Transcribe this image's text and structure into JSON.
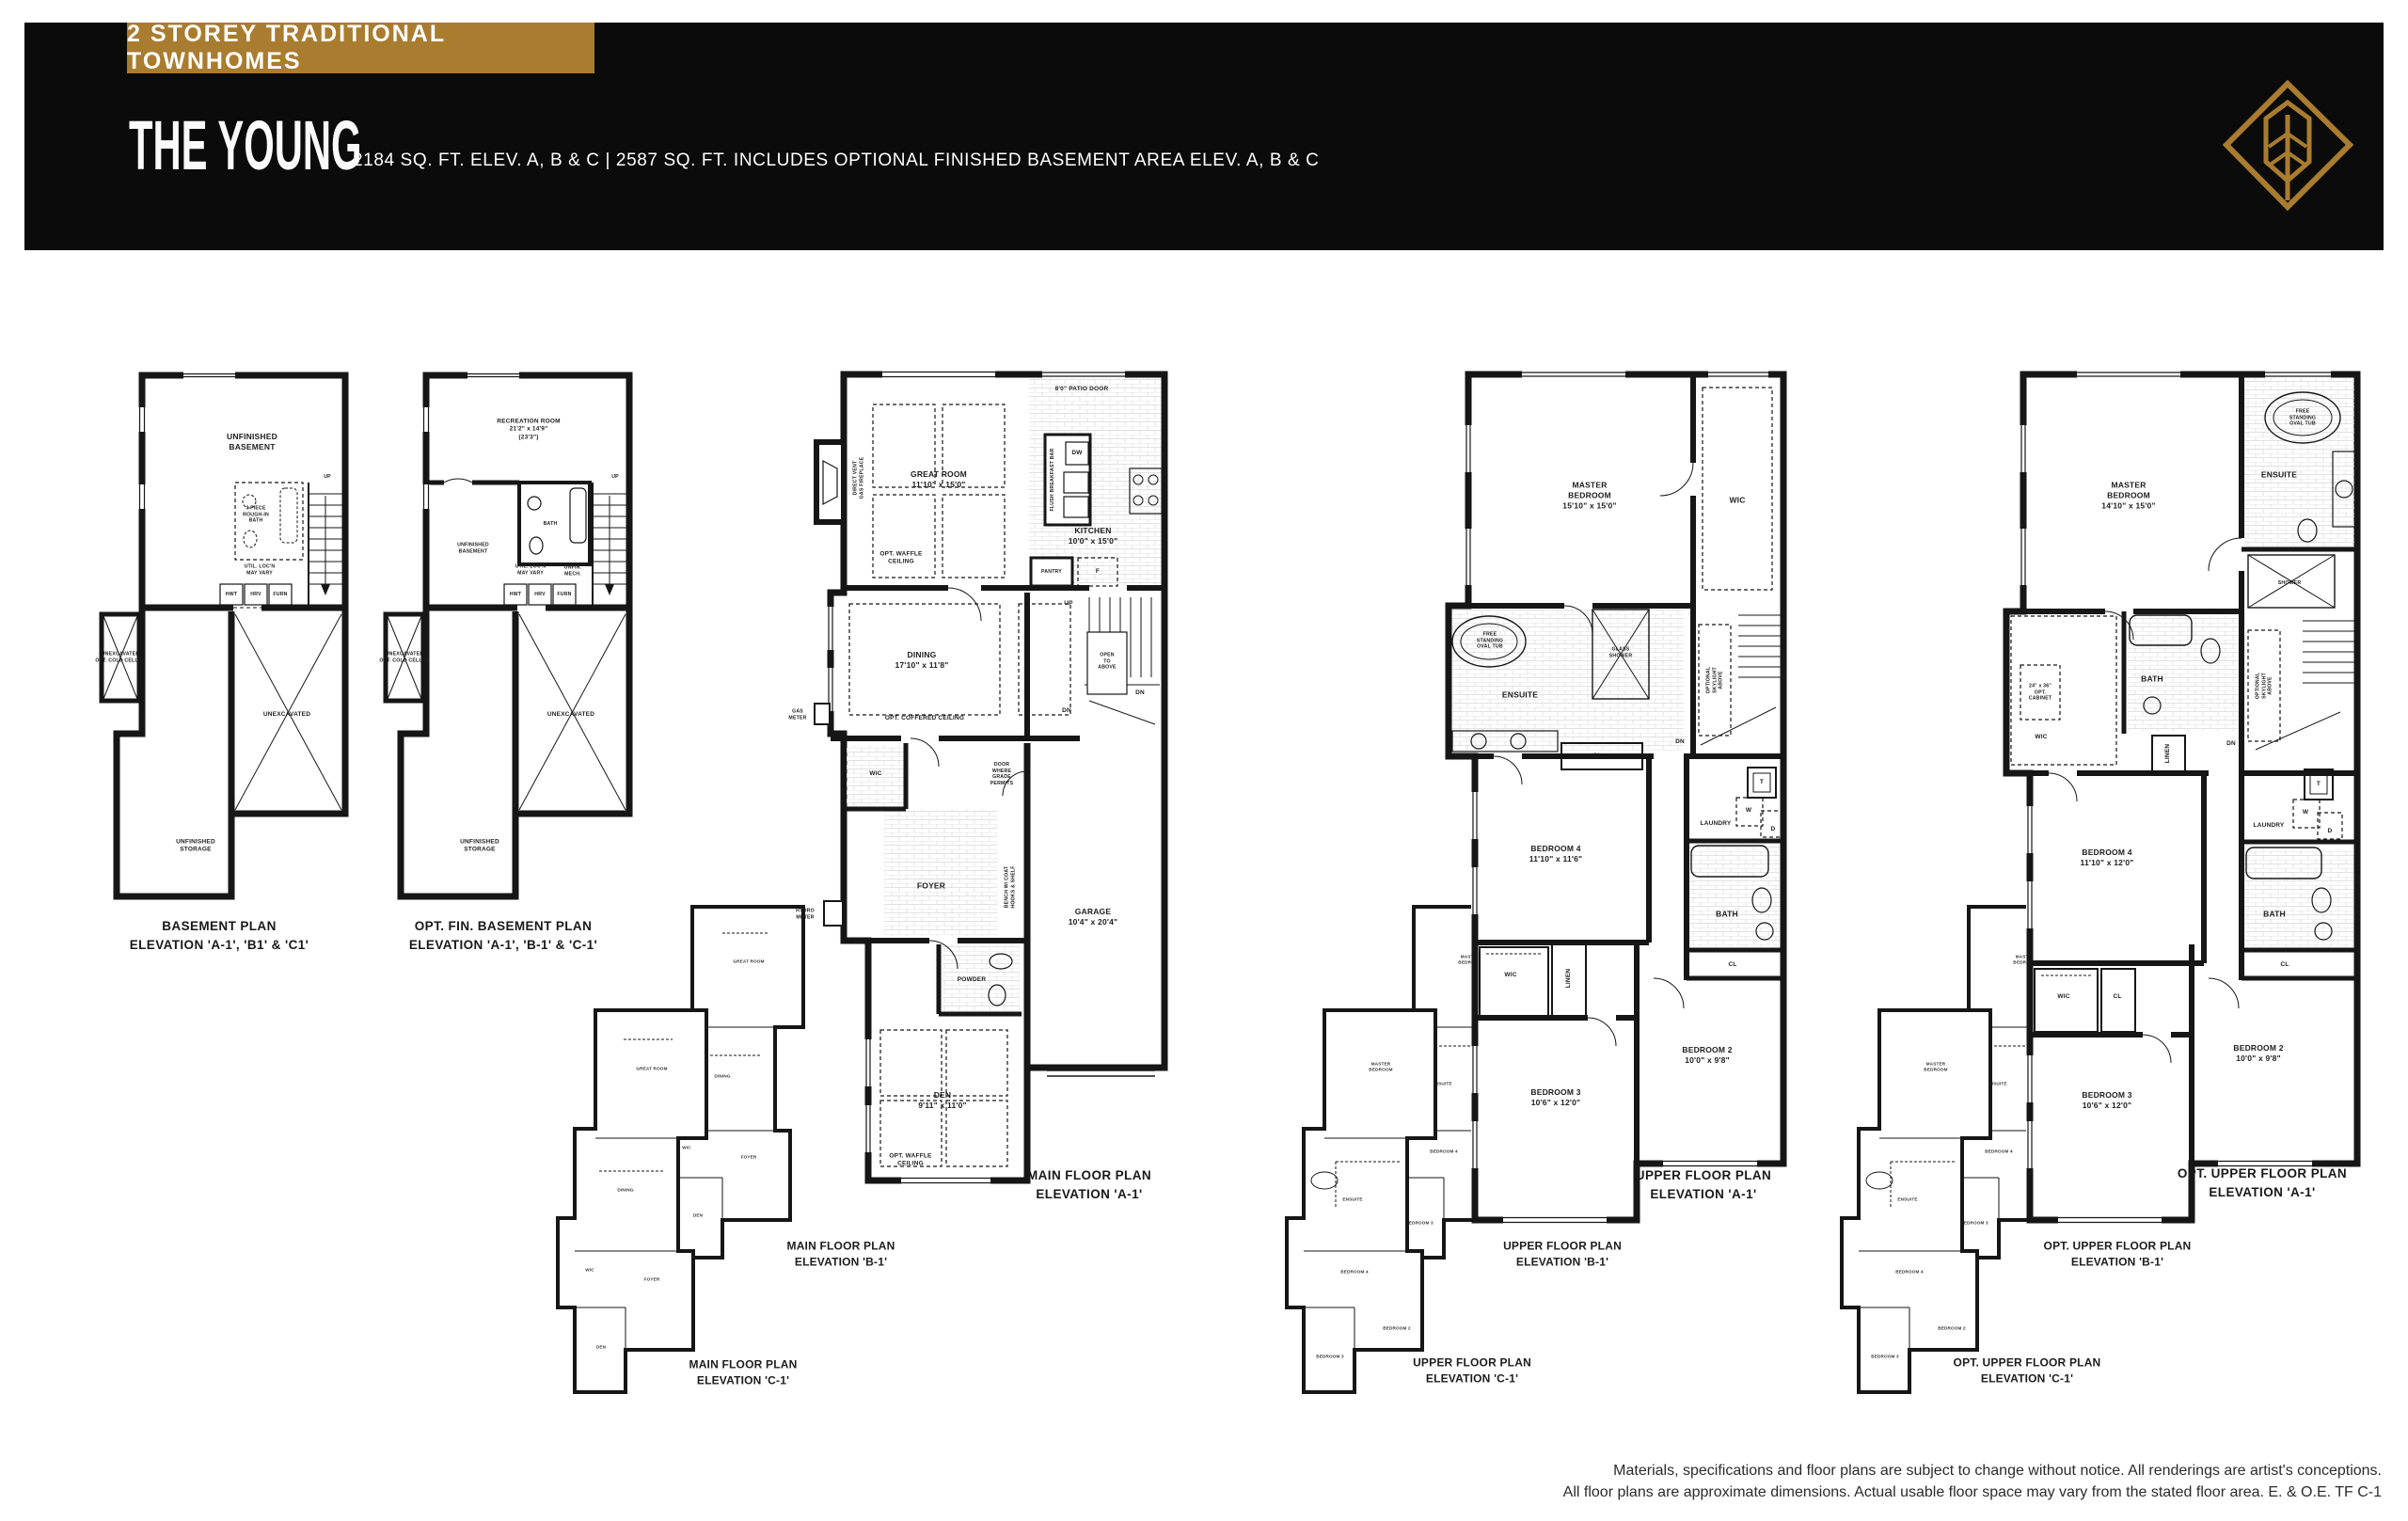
{
  "header": {
    "badge": "2 STOREY TRADITIONAL TOWNHOMES",
    "title": "THE YOUNG",
    "subtitle": "2184 SQ. FT. ELEV. A, B & C   |   2587 SQ. FT. INCLUDES OPTIONAL FINISHED BASEMENT AREA ELEV. A, B & C",
    "accent_color": "#a97c2f",
    "band_color": "#0b0b0b"
  },
  "plans": {
    "basement": {
      "title": "BASEMENT PLAN\nELEVATION 'A-1', 'B1' & 'C1'",
      "labels": {
        "unfinished_basement": "UNFINISHED\nBASEMENT",
        "rough_in_bath": "3 PIECE\nROUGH-IN\nBATH",
        "up": "UP",
        "util_note": "UTIL. LOC'N\nMAY VARY",
        "hwt": "HWT",
        "hrv": "HRV",
        "furn": "FURN",
        "unexcavated_cold_cellar": "UNEXCAVATED\nOPT. COLD CELLAR",
        "unexcavated": "UNEXCAVATED",
        "unfinished_storage": "UNFINISHED\nSTORAGE"
      }
    },
    "opt_basement": {
      "title": "OPT. FIN. BASEMENT PLAN\nELEVATION 'A-1', 'B-1' & 'C-1'",
      "labels": {
        "recreation_room": "RECREATION ROOM\n21'2\" x 14'9\"\n(23'3\")",
        "bath": "BATH",
        "unfinished_basement": "UNFINISHED\nBASEMENT",
        "util_note": "UTIL. LOC'N\nMAY VARY",
        "unfin_mech": "UNFIN.\nMECH.",
        "hwt": "HWT",
        "hrv": "HRV",
        "furn": "FURN",
        "up": "UP",
        "unexcavated_cold_cellar": "UNEXCAVATED\nOPT. COLD CELLAR",
        "unexcavated": "UNEXCAVATED",
        "unfinished_storage": "UNFINISHED\nSTORAGE"
      }
    },
    "main_a": {
      "title": "MAIN FLOOR PLAN\nELEVATION 'A-1'",
      "labels": {
        "patio_door": "8'0\" PATIO DOOR",
        "great_room": "GREAT ROOM\n11'10\" x 15'0\"",
        "opt_waffle_ceiling": "OPT. WAFFLE\nCEILING",
        "fireplace": "DIRECT VENT\nGAS FIREPLACE",
        "dw": "DW",
        "breakfast_bar": "FLUSH BREAKFAST BAR",
        "kitchen": "KITCHEN\n10'0\" x 15'0\"",
        "pantry": "PANTRY",
        "fridge": "F",
        "dining": "DINING\n17'10\" x 11'8\"",
        "opt_coffered_ceiling": "OPT. COFFERED CEILING",
        "up": "UP",
        "open_to_above": "OPEN\nTO\nABOVE",
        "dn_upper": "DN",
        "dn_lower": "DN",
        "gas_meter": "GAS\nMETER",
        "wic": "WIC",
        "door_grade": "DOOR\nWHERE\nGRADE\nPERMITS",
        "foyer": "FOYER",
        "hydro_meter": "HYDRO\nMETER",
        "bench": "BENCH W/ COAT\nHOOKS & SHELF",
        "powder": "POWDER",
        "den": "DEN\n9'11\" x 11'0\"",
        "opt_waffle_ceiling2": "OPT. WAFFLE\nCEILING",
        "garage": "GARAGE\n10'4\" x 20'4\""
      }
    },
    "main_b": {
      "title": "MAIN FLOOR PLAN\nELEVATION 'B-1'"
    },
    "main_c": {
      "title": "MAIN FLOOR PLAN\nELEVATION 'C-1'"
    },
    "mini_main": {
      "labels": {
        "great_room": "GREAT ROOM",
        "dining": "DINING",
        "wic": "WIC",
        "foyer": "FOYER",
        "den": "DEN"
      }
    },
    "upper_a": {
      "title": "UPPER FLOOR PLAN\nELEVATION 'A-1'",
      "labels": {
        "master": "MASTER\nBEDROOM\n15'10\" x 15'0\"",
        "wic_master": "WIC",
        "oval_tub": "FREE\nSTANDING\nOVAL TUB",
        "glass_shower": "GLASS\nSHOWER",
        "ensuite": "ENSUITE",
        "skylight": "OPTIONAL\nSKYLIGHT\nABOVE",
        "dn": "DN",
        "cl_hall": "CL",
        "laundry": "LAUNDRY",
        "t": "T",
        "w": "W",
        "d": "D",
        "bath": "BATH",
        "bedroom4": "BEDROOM 4\n11'10\" x 11'6\"",
        "wic2": "WIC",
        "linen": "LINEN",
        "cl2": "CL",
        "bedroom2": "BEDROOM 2\n10'0\" x 9'8\"",
        "bedroom3": "BEDROOM 3\n10'6\" x 12'0\""
      }
    },
    "upper_b": {
      "title": "UPPER FLOOR PLAN\nELEVATION 'B-1'"
    },
    "upper_c": {
      "title": "UPPER FLOOR PLAN\nELEVATION 'C-1'"
    },
    "mini_upper": {
      "labels": {
        "master": "MASTER\nBEDROOM",
        "ensuite": "ENSUITE",
        "bedroom4": "BEDROOM 4",
        "bedroom2": "BEDROOM 2",
        "bedroom3": "BEDROOM 3"
      }
    },
    "opt_upper_a": {
      "title": "OPT. UPPER FLOOR PLAN\nELEVATION 'A-1'",
      "labels": {
        "master": "MASTER\nBEDROOM\n14'10\" x 15'0\"",
        "oval_tub": "FREE\nSTANDING\nOVAL TUB",
        "ensuite": "ENSUITE",
        "shower": "SHOWER",
        "opt_cabinet": "24\" x 36\"\nOPT.\nCABINET",
        "wic_master": "WIC",
        "bath_main": "BATH",
        "linen": "LINEN",
        "skylight": "OPTIONAL\nSKYLIGHT\nABOVE",
        "dn": "DN",
        "laundry": "LAUNDRY",
        "t": "T",
        "w": "W",
        "d": "D",
        "bath2": "BATH",
        "cl_hall": "CL",
        "bedroom4": "BEDROOM 4\n11'10\" x 12'0\"",
        "wic2": "WIC",
        "cl2": "CL",
        "bedroom2": "BEDROOM 2\n10'0\" x 9'8\"",
        "bedroom3": "BEDROOM 3\n10'6\" x 12'0\""
      }
    },
    "opt_upper_b": {
      "title": "OPT. UPPER FLOOR PLAN\nELEVATION 'B-1'"
    },
    "opt_upper_c": {
      "title": "OPT. UPPER FLOOR PLAN\nELEVATION 'C-1'"
    }
  },
  "disclaimer": {
    "line1": "Materials, specifications and floor plans are subject to change without notice. All renderings are artist's conceptions.",
    "line2": "All floor plans are approximate dimensions. Actual usable floor space may vary from the stated floor area. E. & O.E. TF  C-1"
  }
}
